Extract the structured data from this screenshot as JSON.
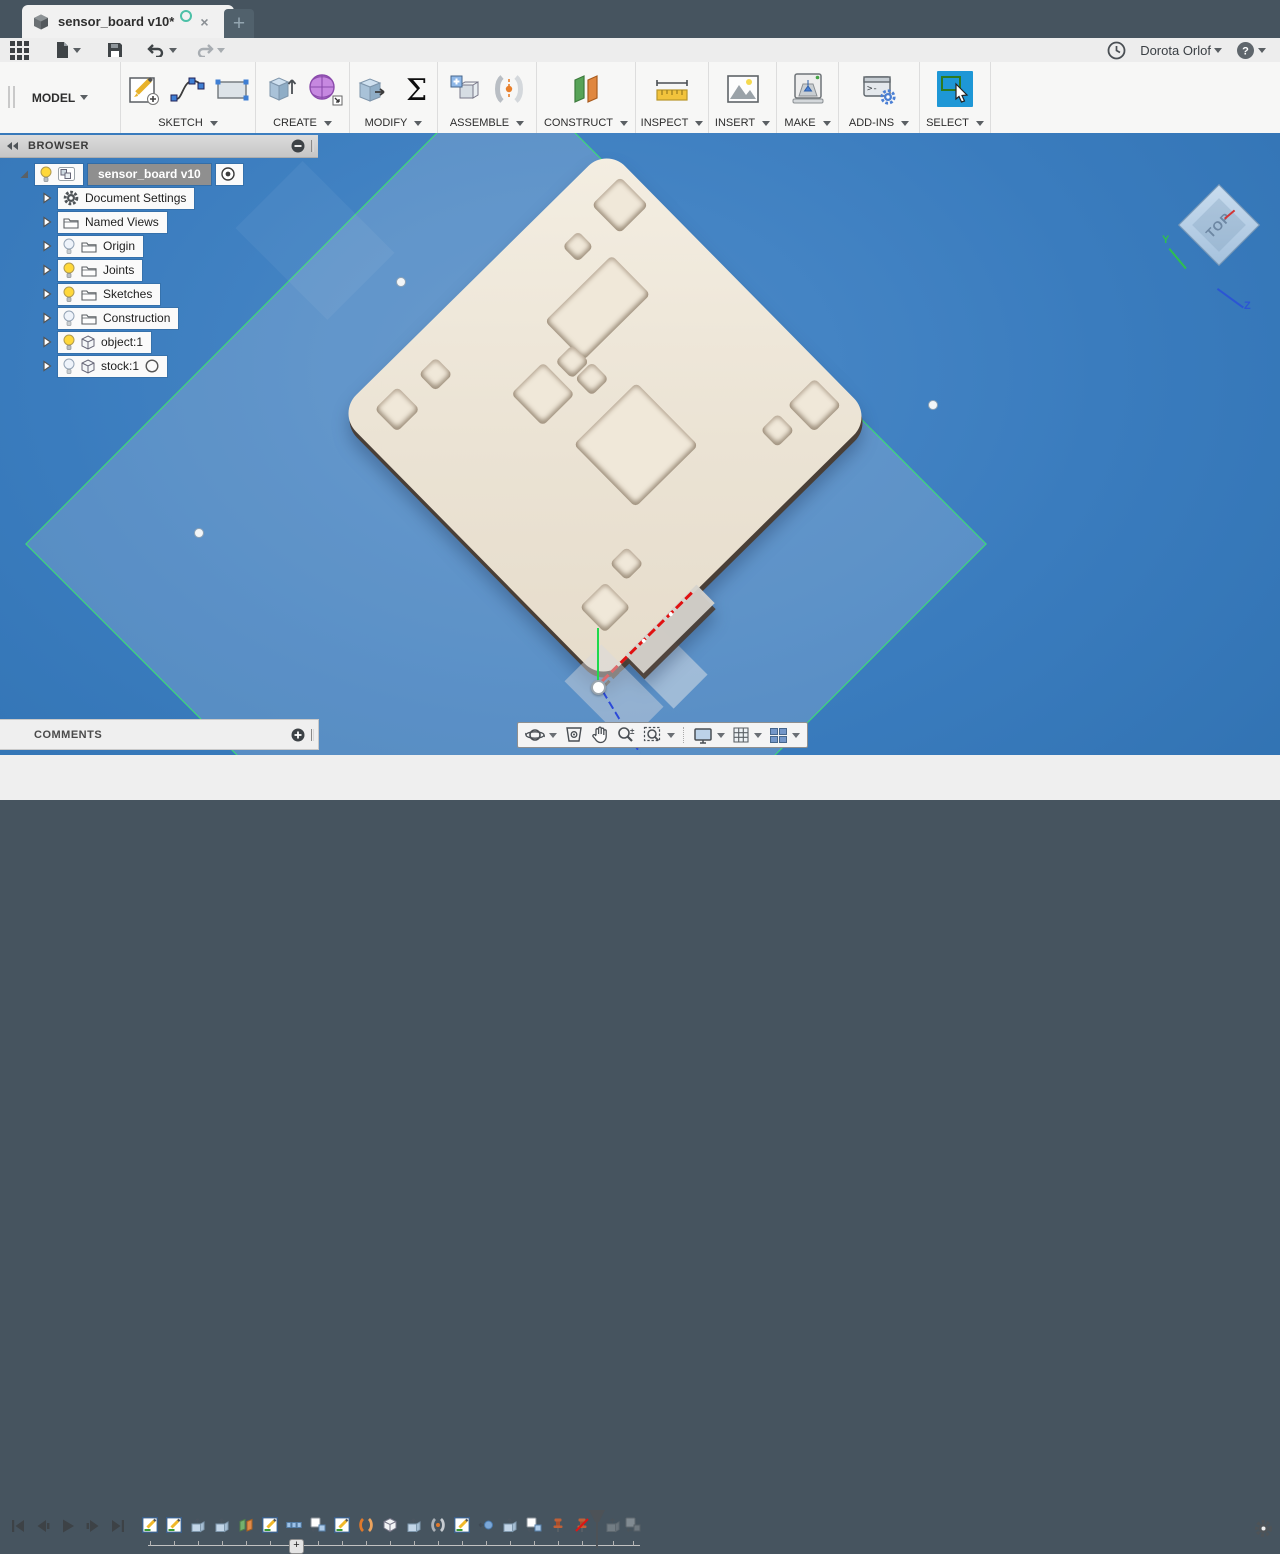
{
  "window": {
    "title": "sensor_board v10*",
    "close_glyph": "×",
    "new_tab_glyph": "+"
  },
  "menu_bar": {
    "user": "Dorota Orlof",
    "help_glyph": "?"
  },
  "ribbon": {
    "workspace": "MODEL",
    "groups": [
      {
        "label": "SKETCH",
        "width": 134,
        "items": [
          "create-sketch",
          "spline",
          "rectangle"
        ]
      },
      {
        "label": "CREATE",
        "width": 93,
        "items": [
          "extrude",
          "form"
        ]
      },
      {
        "label": "MODIFY",
        "width": 87,
        "items": [
          "press-pull",
          "parameters"
        ]
      },
      {
        "label": "ASSEMBLE",
        "width": 98,
        "items": [
          "new-component",
          "joint"
        ]
      },
      {
        "label": "CONSTRUCT",
        "width": 98,
        "items": [
          "plane"
        ]
      },
      {
        "label": "INSPECT",
        "width": 72,
        "items": [
          "measure"
        ]
      },
      {
        "label": "INSERT",
        "width": 67,
        "items": [
          "insert-image"
        ]
      },
      {
        "label": "MAKE",
        "width": 61,
        "items": [
          "print"
        ]
      },
      {
        "label": "ADD-INS",
        "width": 80,
        "items": [
          "scripts"
        ]
      },
      {
        "label": "SELECT",
        "width": 70,
        "items": [
          "select"
        ],
        "active": true
      }
    ]
  },
  "browser": {
    "header": "BROWSER",
    "rows": [
      {
        "label": "sensor_board v10",
        "icon": "component",
        "bulb": "on",
        "selected": true,
        "trailing": "radio"
      },
      {
        "label": "Document Settings",
        "icon": "gear"
      },
      {
        "label": "Named Views",
        "icon": "folder"
      },
      {
        "label": "Origin",
        "icon": "folder",
        "bulb": "off"
      },
      {
        "label": "Joints",
        "icon": "folder",
        "bulb": "on"
      },
      {
        "label": "Sketches",
        "icon": "folder",
        "bulb": "on"
      },
      {
        "label": "Construction",
        "icon": "folder",
        "bulb": "off"
      },
      {
        "label": "object:1",
        "icon": "body",
        "bulb": "on"
      },
      {
        "label": "stock:1",
        "icon": "body",
        "bulb": "off",
        "trailing": "circle"
      }
    ]
  },
  "comments": {
    "header": "COMMENTS"
  },
  "viewcube": {
    "face": "TOP",
    "axis_y": "Y",
    "axis_z": "Z"
  },
  "nav_bar": {
    "buttons": [
      {
        "name": "orbit",
        "dropdown": true
      },
      {
        "name": "look-at",
        "dropdown": false
      },
      {
        "name": "pan",
        "dropdown": false
      },
      {
        "name": "zoom",
        "dropdown": false
      },
      {
        "name": "fit",
        "dropdown": true
      },
      {
        "name": "display",
        "dropdown": true
      },
      {
        "name": "grid",
        "dropdown": true
      },
      {
        "name": "viewports",
        "dropdown": true
      }
    ]
  },
  "timeline": {
    "transport": [
      "go-to-start",
      "step-back",
      "play",
      "step-forward",
      "go-to-end"
    ],
    "features": [
      "sketch",
      "sketch",
      "extrude",
      "extrude",
      "plane",
      "sketch",
      "pattern",
      "component",
      "sketch",
      "joint",
      "body",
      "extrude",
      "joint2",
      "sketch",
      "point",
      "extrude",
      "component",
      "pin",
      "pin-off"
    ],
    "future_features": [
      "extrude",
      "component"
    ],
    "zoom_glyph": "+"
  },
  "colors": {
    "accent_blue": "#1e97d6",
    "sketch_green": "#39e56a",
    "viewport_blue": "#3a7cbe",
    "board_cream": "#ece4d6",
    "tab_bar": "#46545f"
  },
  "model": {
    "board_pockets": [
      [
        30,
        11,
        40,
        40
      ],
      [
        39,
        79,
        22,
        22
      ],
      [
        80,
        72,
        55,
        94
      ],
      [
        116,
        163,
        24,
        24
      ],
      [
        142,
        161,
        24,
        24
      ],
      [
        108,
        196,
        45,
        45
      ],
      [
        188,
        144,
        88,
        88
      ],
      [
        23,
        317,
        32,
        32
      ],
      [
        29,
        269,
        24,
        24
      ],
      [
        310,
        14,
        38,
        38
      ],
      [
        309,
        65,
        24,
        24
      ],
      [
        298,
        266,
        24,
        24
      ],
      [
        308,
        306,
        36,
        36
      ]
    ],
    "sketch_points": [
      [
        400,
        148
      ],
      [
        198,
        399
      ],
      [
        932,
        271
      ]
    ]
  }
}
